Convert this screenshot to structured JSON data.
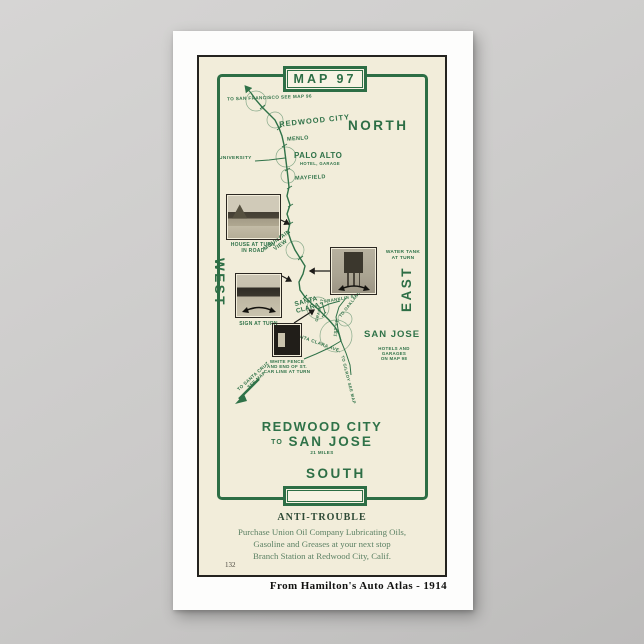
{
  "frame": {
    "map_label": "MAP 97"
  },
  "compass": {
    "north": "NORTH",
    "south": "SOUTH",
    "east": "EAST",
    "west": "WEST"
  },
  "route": {
    "to_san_francisco": "TO SAN FRANCISCO SEE MAP 96",
    "redwood_city": "REDWOOD CITY",
    "menlo": "MENLO",
    "palo_alto": "PALO ALTO",
    "palo_alto_note": "HOTEL, GARAGE",
    "university": "UNIVERSITY",
    "mayfield": "MAYFIELD",
    "mountain_view_1": "MOUNTAIN",
    "mountain_view_2": "VIEW",
    "santa_clara_1": "SANTA",
    "santa_clara_2": "CLARA",
    "franklin_st": "FRANKLIN ST.",
    "grant_st": "GRANT ST.",
    "first_st": "1ST ST.",
    "santa_clara_ave": "SANTA CLARA AVE.",
    "to_oakland": "TO OAKLAND MAP 98",
    "san_jose": "SAN JOSE",
    "san_jose_note_1": "HOTELS AND",
    "san_jose_note_2": "GARAGES",
    "san_jose_note_3": "ON MAP 98",
    "to_gilroy": "TO GILROY SEE MAP",
    "to_santa_cruz_1": "TO SANTA CRUZ",
    "to_santa_cruz_2": "SEE MAP"
  },
  "photos": {
    "house_caption_1": "HOUSE AT TURN",
    "house_caption_2": "IN ROAD",
    "sign_caption": "SIGN AT TURN",
    "water_tank_caption_1": "WATER TANK",
    "water_tank_caption_2": "AT TURN",
    "white_fence_caption_1": "WHITE FENCE",
    "white_fence_caption_2": "AND END OF ST.",
    "white_fence_caption_3": "CAR LINE AT TURN"
  },
  "title": {
    "line1": "REDWOOD CITY",
    "to": "TO",
    "line2": "SAN JOSE",
    "miles": "21 MILES"
  },
  "ad": {
    "heading": "ANTI-TROUBLE",
    "line1": "Purchase Union Oil Company Lubricating Oils,",
    "line2": "Gasoline and Greases at your next stop",
    "line3": "Branch Station at Redwood City, Calif."
  },
  "page_number": "132",
  "attribution": "From Hamilton's Auto Atlas - 1914",
  "colors": {
    "green": "#2d6e45",
    "cream": "#f2edda",
    "ink": "#24231f"
  }
}
